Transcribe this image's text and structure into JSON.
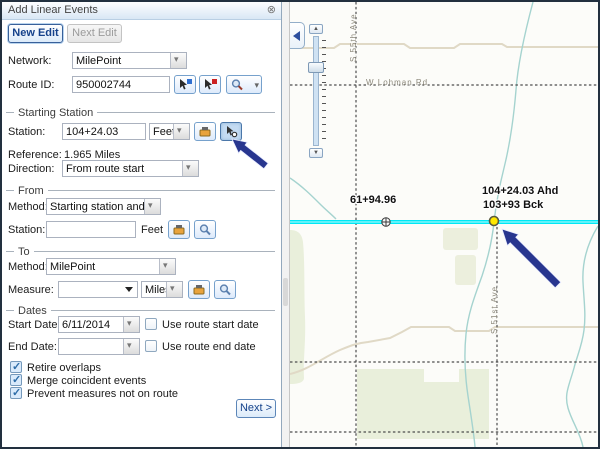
{
  "window": {
    "title": "Add Linear Events"
  },
  "icons": {
    "close": "⊗"
  },
  "panel": {
    "buttons": {
      "new_edit": "New Edit",
      "next_edit": "Next Edit",
      "next": "Next >"
    },
    "network": {
      "label": "Network:",
      "value": "MilePoint"
    },
    "route_id": {
      "label": "Route ID:",
      "value": "950002744"
    },
    "starting_station": {
      "section_label": "Starting Station",
      "station_label": "Station:",
      "station_value": "104+24.03",
      "unit": "Feet",
      "reference_label": "Reference:",
      "reference_value": "1.965 Miles",
      "direction_label": "Direction:",
      "direction_value": "From route start"
    },
    "from": {
      "section_label": "From",
      "method_label": "Method:",
      "method_value": "Starting station and offset",
      "station_label": "Station:",
      "station_value": "",
      "unit": "Feet"
    },
    "to": {
      "section_label": "To",
      "method_label": "Method:",
      "method_value": "MilePoint",
      "measure_label": "Measure:",
      "measure_value": "",
      "unit": "Miles"
    },
    "dates": {
      "section_label": "Dates",
      "start_label": "Start Date:",
      "start_value": "6/11/2014",
      "start_checkbox": "Use route start date",
      "end_label": "End Date:",
      "end_value": "",
      "end_checkbox": "Use route end date"
    },
    "options": [
      {
        "label": "Retire overlaps",
        "checked": true
      },
      {
        "label": "Merge coincident events",
        "checked": true
      },
      {
        "label": "Prevent measures not on route",
        "checked": true
      }
    ]
  },
  "map": {
    "roads": {
      "vertical_1": "S 55th Ave",
      "horizontal_1": "W Lohman Rd",
      "vertical_2": "S 51st Ave"
    },
    "labels": {
      "station_point": "61+94.96",
      "ahead": "104+24.03 Ahd",
      "back": "103+93 Bck"
    },
    "colors": {
      "route_highlight": "#00e8f5",
      "selected_point": "#ffe800",
      "annotation_arrow": "#28368f",
      "river": "#a5d3cf",
      "park": "#e9efdb",
      "road_beige": "#e0d9c6"
    }
  }
}
